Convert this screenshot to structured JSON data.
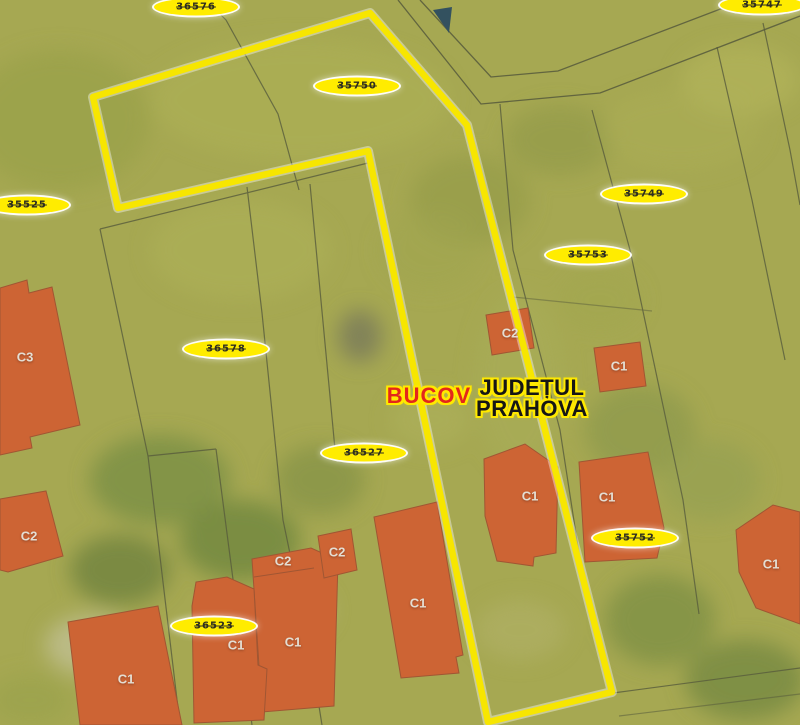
{
  "map": {
    "labels": {
      "locality": "BUCOV",
      "county_line1": "JUDEȚUL",
      "county_line2": "PRAHOVA"
    },
    "badges": [
      {
        "number": "36576"
      },
      {
        "number": "35750"
      },
      {
        "number": "35525"
      },
      {
        "number": "35749"
      },
      {
        "number": "35753"
      },
      {
        "number": "36578"
      },
      {
        "number": "36527"
      },
      {
        "number": "35752"
      },
      {
        "number": "36523"
      },
      {
        "number": "35747"
      }
    ],
    "buildings": [
      {
        "label": "C3"
      },
      {
        "label": "C2"
      },
      {
        "label": "C1"
      },
      {
        "label": "C1"
      },
      {
        "label": "C1"
      },
      {
        "label": "C1"
      },
      {
        "label": "C2"
      },
      {
        "label": "C2"
      },
      {
        "label": "C2"
      },
      {
        "label": "C1"
      },
      {
        "label": "C1"
      },
      {
        "label": "C1"
      },
      {
        "label": "C1"
      }
    ],
    "colors": {
      "background": "#a6a852",
      "highlight_boundary": "#f7e600",
      "building_fill": "#cd6434",
      "badge_fill": "#ffec00",
      "locality_text": "#e3261c",
      "county_text": "#161616"
    }
  }
}
